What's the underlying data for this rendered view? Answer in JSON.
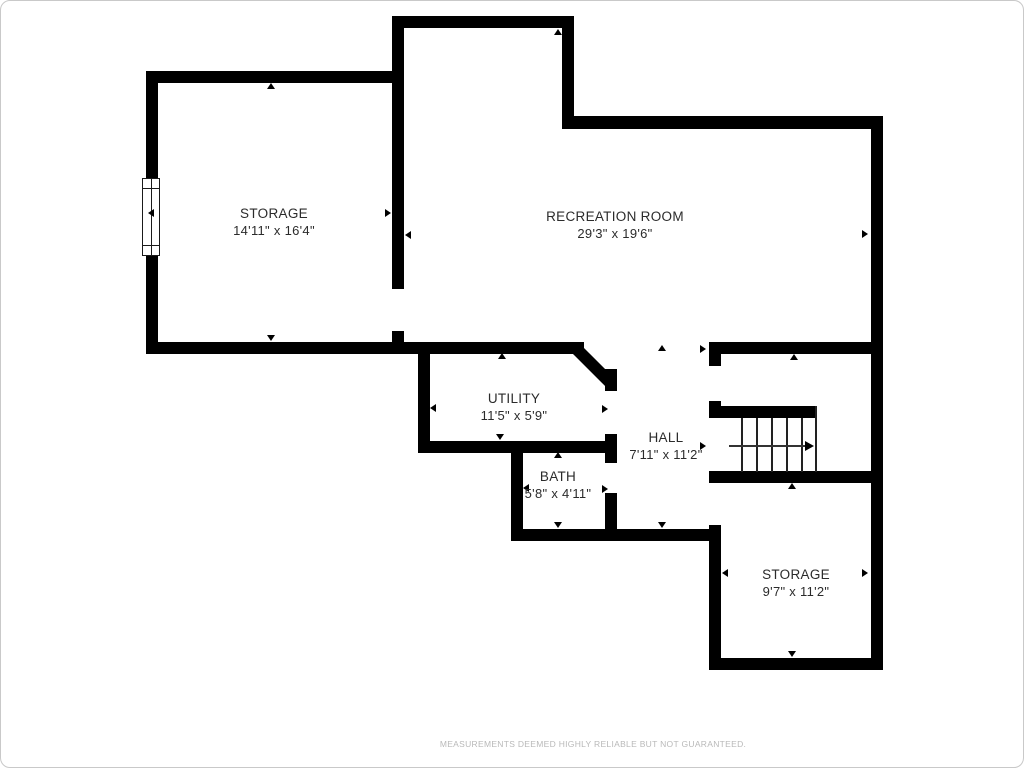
{
  "rooms": [
    {
      "id": "storage-upper",
      "name": "STORAGE",
      "dims": "14'11\" x 16'4\""
    },
    {
      "id": "recreation-room",
      "name": "RECREATION ROOM",
      "dims": "29'3\" x 19'6\""
    },
    {
      "id": "utility",
      "name": "UTILITY",
      "dims": "11'5\" x 5'9\""
    },
    {
      "id": "hall",
      "name": "HALL",
      "dims": "7'11\" x 11'2\""
    },
    {
      "id": "bath",
      "name": "BATH",
      "dims": "5'8\" x 4'11\""
    },
    {
      "id": "storage-lower",
      "name": "STORAGE",
      "dims": "9'7\" x 11'2\""
    }
  ],
  "features": {
    "stairs": {
      "treads": 6,
      "arrow_direction": "right"
    },
    "window": {
      "wall": "left"
    }
  },
  "footer": {
    "disclaimer": "MEASUREMENTS DEEMED HIGHLY RELIABLE BUT NOT GUARANTEED."
  },
  "colors": {
    "wall": "#000000",
    "label_text": "#2b2b2b",
    "disclaimer_text": "#b9b9b9",
    "border": "#c9c9c9",
    "background": "#ffffff"
  }
}
